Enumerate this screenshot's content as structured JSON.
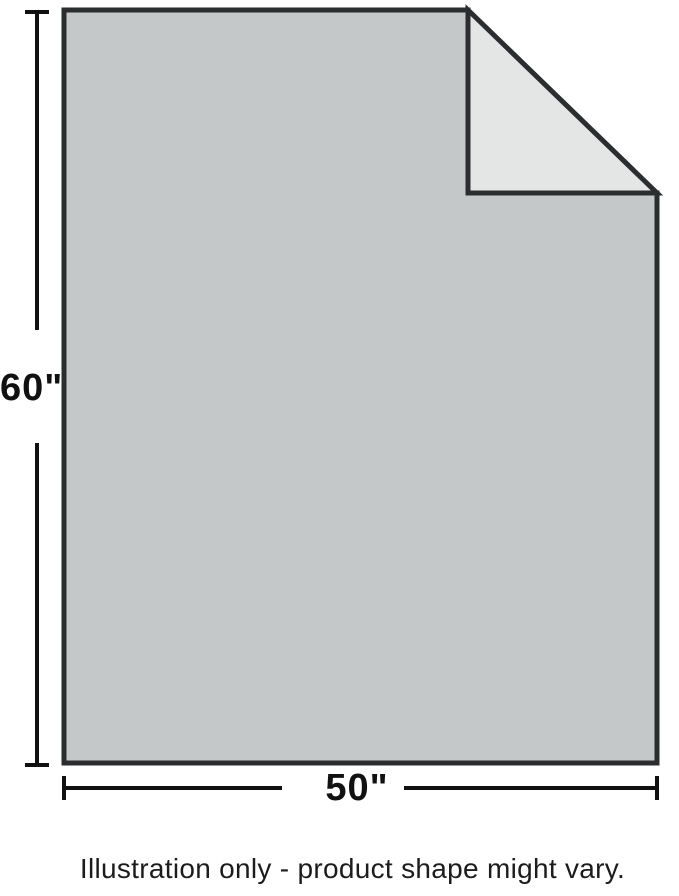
{
  "diagram": {
    "product": "blanket-dimension-illustration",
    "height_label": "60\"",
    "width_label": "50\"",
    "caption": "Illustration only - product shape might vary.",
    "colors": {
      "blanket_fill": "#c5c8c8",
      "fold_fill": "#e4e6e6",
      "outline": "#2b2d2e",
      "dimension": "#111111",
      "background": "#ffffff"
    }
  }
}
